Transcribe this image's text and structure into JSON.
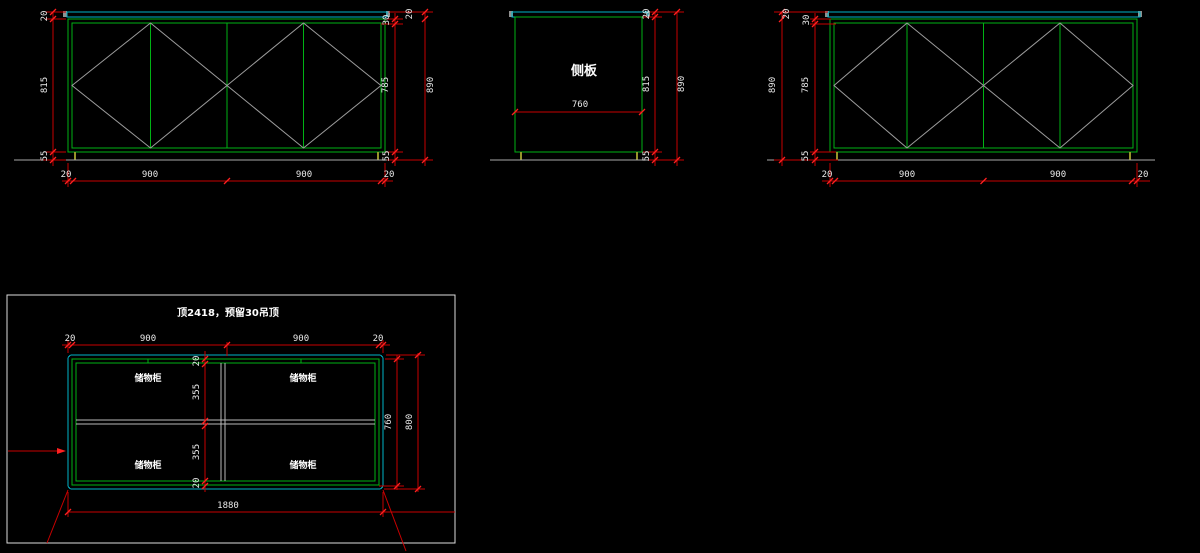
{
  "colors": {
    "bg": "#000000",
    "green": "#00b214",
    "cyan": "#00b4c8",
    "red": "#c80000",
    "redb": "#ff2020",
    "gray": "#9c9c9c",
    "gray2": "#b9b9b9",
    "ground": "#a9a9a9",
    "olive": "#96962a",
    "cap": "#909090",
    "text": "#e9e9e9",
    "border": "#dcdcdc"
  },
  "views": {
    "front_left": {
      "dims": {
        "left_counter": "20",
        "left_body": "815",
        "left_plinth": "55",
        "right_rail": "30",
        "right_door": "785",
        "right_plinth": "55",
        "right_counter": "20",
        "right_total": "890",
        "bottom": [
          "20",
          "900",
          "900",
          "20"
        ]
      }
    },
    "side": {
      "label": "侧板",
      "dims": {
        "counter": "20",
        "body": "815",
        "plinth": "55",
        "total": "890",
        "depth": "760"
      }
    },
    "front_right": {
      "dims": {
        "counter": "20",
        "rail": "30",
        "door": "785",
        "plinth": "55",
        "total": "890",
        "bottom": [
          "20",
          "900",
          "900",
          "20"
        ]
      }
    },
    "plan": {
      "title": "顶2418，预留30吊顶",
      "cells": [
        "储物柜",
        "储物柜",
        "储物柜",
        "储物柜"
      ],
      "dims": {
        "top": [
          "20",
          "900",
          "900",
          "20"
        ],
        "inner_chain": [
          "20",
          "355",
          "355",
          "20"
        ],
        "depth_inner": "760",
        "depth_outer": "800",
        "width_total": "1880"
      }
    }
  }
}
